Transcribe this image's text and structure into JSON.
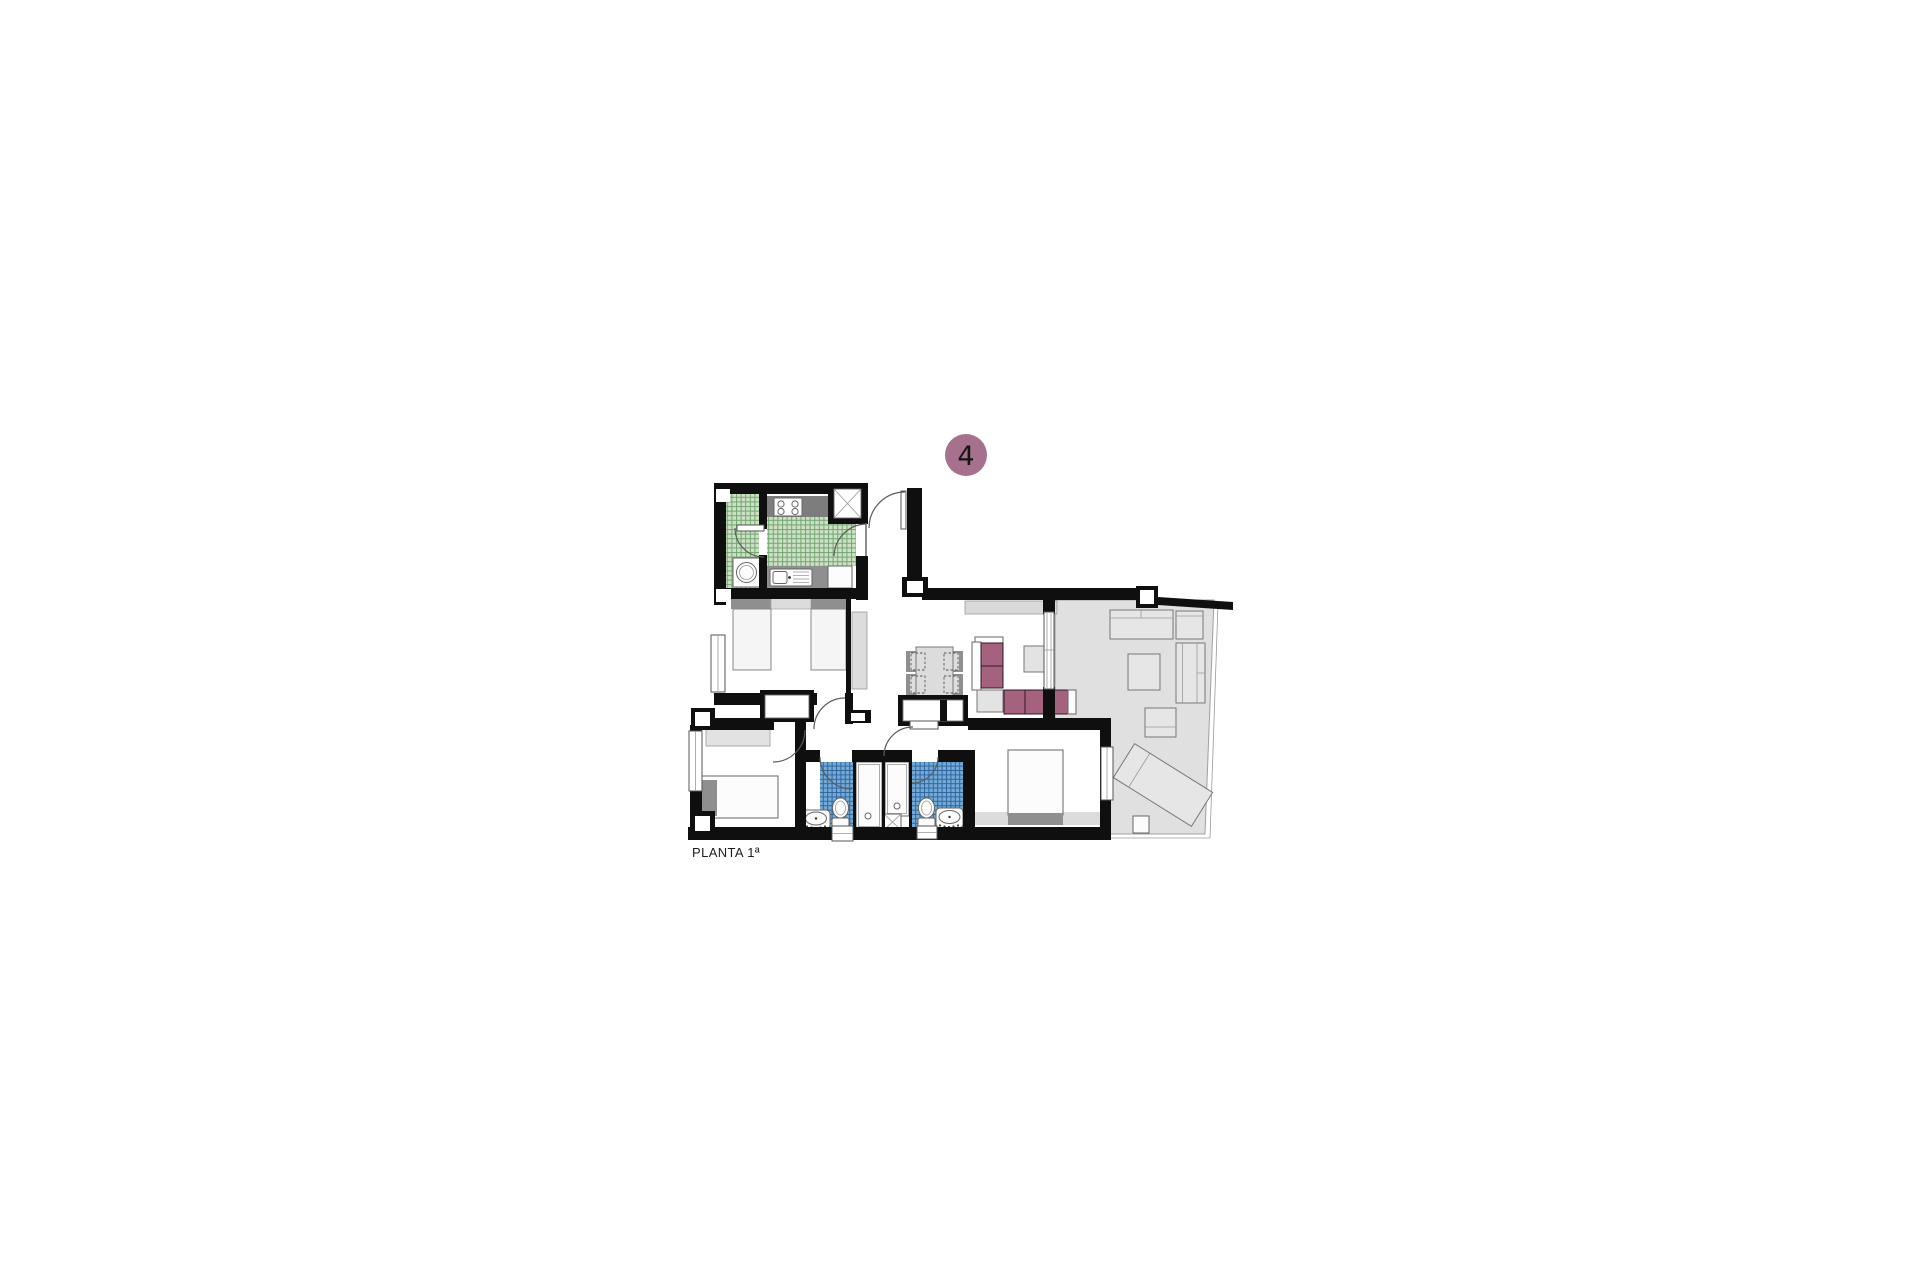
{
  "floor_plan": {
    "label": "PLANTA 1ª",
    "unit_badge": {
      "number": "4",
      "color": "#a7718d"
    },
    "colors": {
      "wall": "#0f0f0f",
      "kitchen_tile_base": "#cde1c5",
      "kitchen_tile_line": "#74a674",
      "bath_tile_base": "#74abd6",
      "bath_tile_line": "#30659e",
      "sofa_cushion": "#a4627e",
      "terrace_floor": "#e0e0e0",
      "furniture_light": "#e6e6e6",
      "furniture_dark": "#8f8f8f",
      "counter_dark": "#7d7d7d",
      "counter_mid": "#8f8f8f",
      "sideboard": "#d9d9d9"
    }
  }
}
